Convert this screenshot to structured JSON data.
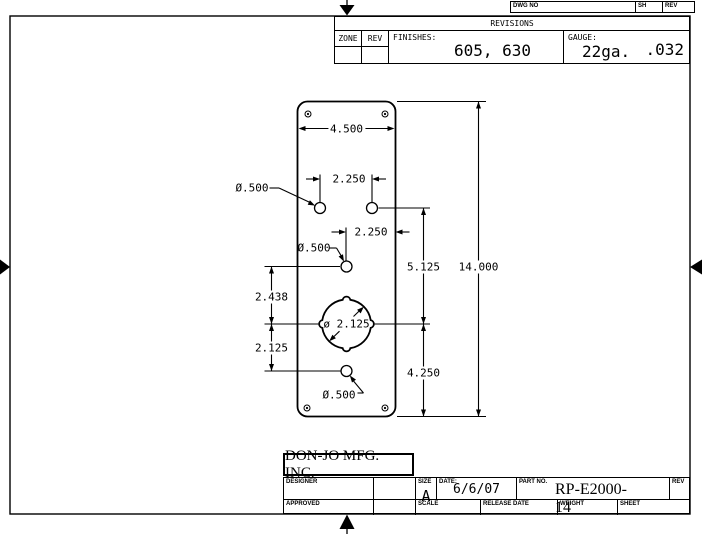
{
  "doc_strip": {
    "dwg_no_label": "DWG NO",
    "sh_label": "SH",
    "rev_label": "REV"
  },
  "revisions": {
    "title": "REVISIONS",
    "zone_label": "ZONE",
    "rev_label": "REV",
    "finishes_label": "FINISHES:",
    "finishes_value": "605, 630",
    "gauge_label": "GAUGE:",
    "gauge_weight": "22ga.",
    "gauge_thickness": ".032"
  },
  "title_block": {
    "company": "DON-JO MFG. INC.",
    "designer_label": "DESIGNER",
    "approved_label": "APPROVED",
    "size_label": "SIZE",
    "size_value": "A",
    "date_label": "DATE:",
    "date_value": "6/6/07",
    "part_no_label": "PART NO.",
    "part_no_value": "RP-E2000-14",
    "rev_label": "REV",
    "scale_label": "SCALE",
    "release_date_label": "RELEASE DATE",
    "weight_label": "WEIGHT",
    "sheet_label": "SHEET"
  },
  "drawing": {
    "plate_width": "4.500",
    "plate_height": "14.000",
    "top_holes_spacing": "2.250",
    "center_hole_offset": "2.250",
    "top_hole_to_center": "5.125",
    "center_to_bottom_edge": "4.250",
    "hole3_to_center": "2.438",
    "center_to_hole4": "2.125",
    "small_hole_dia_top": "Ø.500",
    "small_hole_dia_mid": "Ø.500",
    "small_hole_dia_bottom": "Ø.500",
    "center_hole_dia": "ø 2.125"
  }
}
